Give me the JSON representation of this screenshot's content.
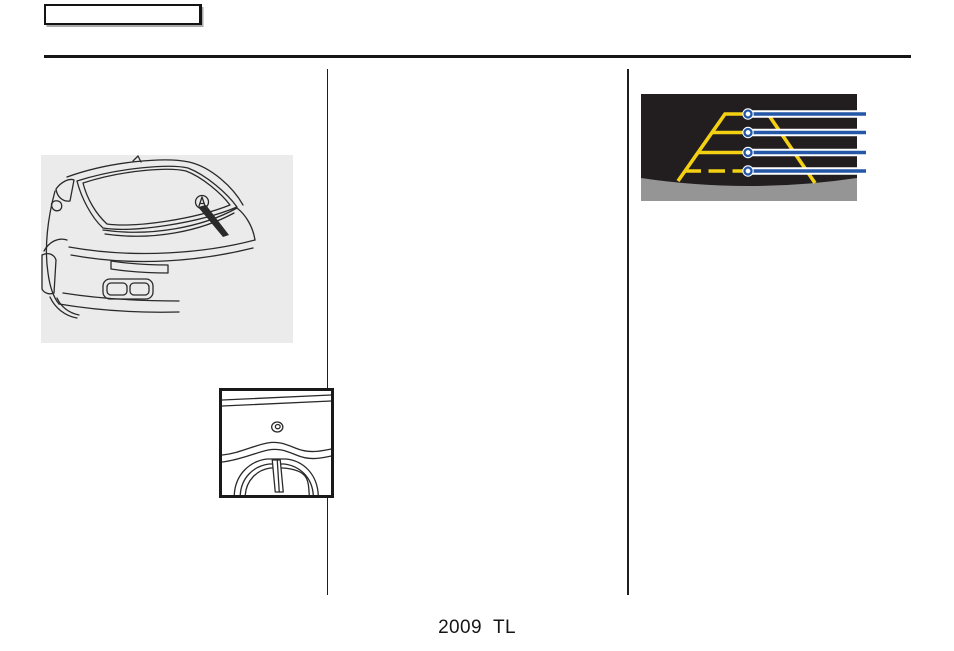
{
  "page": {
    "footer_text": "2009  TL"
  },
  "header": {
    "tab_label": ""
  },
  "figures": {
    "camera_display": {
      "guide_line_count": 4,
      "callout_count": 4
    }
  },
  "theme": {
    "ink": "#2a2a2a",
    "rule": "#161616",
    "panel": "#ebebeb",
    "cam_bg": "#221e1f",
    "bumper": "#959595",
    "yellow": "#f3d112",
    "blue": "#2457a6"
  }
}
